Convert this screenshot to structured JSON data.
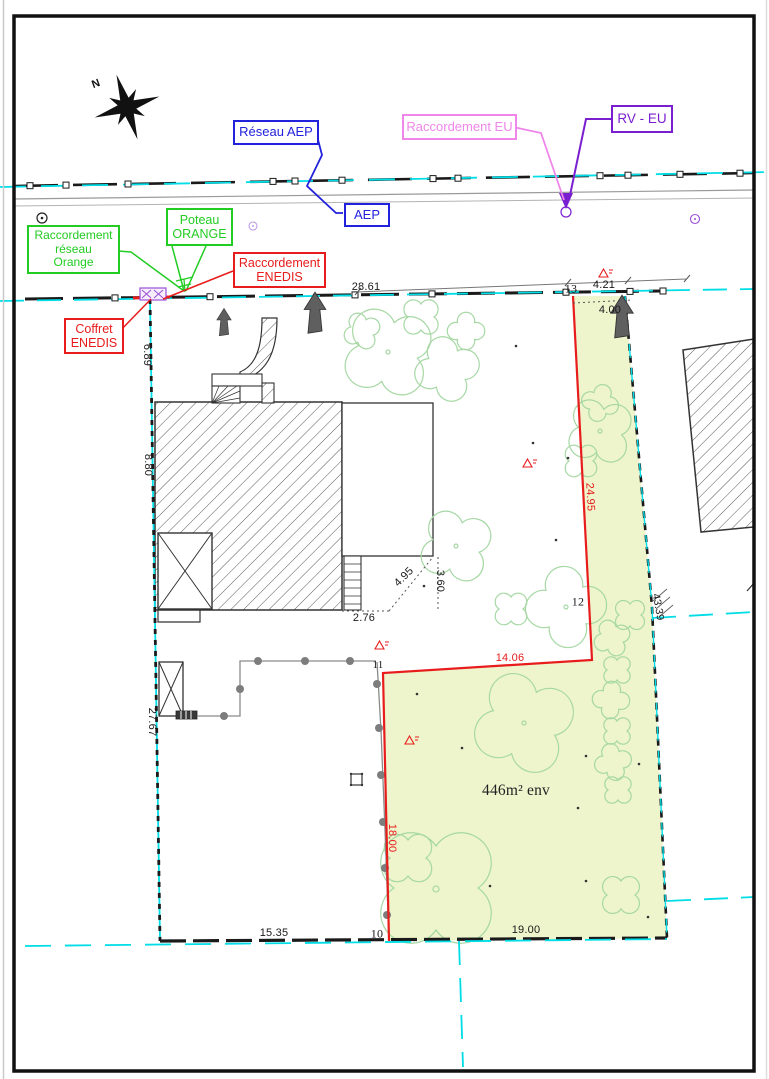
{
  "callouts": {
    "reseau_aep": "Réseau AEP",
    "aep": "AEP",
    "raccordement_eu": "Raccordement EU",
    "rv_eu": "RV - EU",
    "poteau_orange_l1": "Poteau",
    "poteau_orange_l2": "ORANGE",
    "racc_orange_l1": "Raccordement",
    "racc_orange_l2": "réseau",
    "racc_orange_l3": "Orange",
    "racc_enedis_l1": "Raccordement",
    "racc_enedis_l2": "ENEDIS",
    "coffret_enedis_l1": "Coffret",
    "coffret_enedis_l2": "ENEDIS"
  },
  "dimensions": {
    "frontage_total": "28.61",
    "front_seg": "4.21",
    "front_depth": "4.00",
    "east_upper": "24.95",
    "east_total": "43.39",
    "north_inner": "14.06",
    "west_inner": "18.00",
    "south_right": "19.00",
    "south_left": "15.35",
    "west_lower": "27.67",
    "west_mid": "8.80",
    "west_upper": "6.89",
    "house_offset_south": "2.76",
    "house_offset_diag": "4.95",
    "house_offset_east": "3.60"
  },
  "points": {
    "p10": "10",
    "p11": "11",
    "p12": "12",
    "p13": "13"
  },
  "parcel": {
    "area_label": "446m² env"
  },
  "compass": {
    "north_label": "N"
  },
  "colors": {
    "parcel_fill": "#eef4cc",
    "boundary_red": "#e81c1c",
    "network_cyan": "#00dde6",
    "aep_blue": "#2222dd",
    "orange_green": "#22cc22",
    "eu_pink": "#ef86ea",
    "rv_eu_purple": "#7a1fd0",
    "tree_green": "#a6d8a4"
  }
}
